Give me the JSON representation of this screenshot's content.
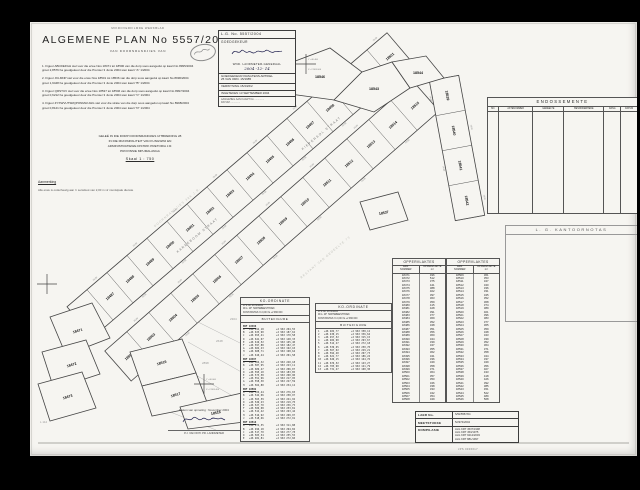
{
  "colors": {
    "page_bg": "#f6f5f1",
    "ink": "#2b2b2b",
    "line": "#555555",
    "faint": "#b5b5b5",
    "signature_ink": "#1a1a4a"
  },
  "header": {
    "microfilm": "MIKROVERFILMDE  WERKBLAD",
    "title": "ALGEMENE  PLAN  No  5557/2004",
    "subtitle": "VAN   DOORNRANDJIES   VAN",
    "notes": [
      "1.  Figuur ABCDEFGH stel voor die erwe Nos 18471 tot 18500 van die dorp soos aangedui op kaart No 8995/2004\n      groot 2,8576 ha        goedgekeur deur die Premier 3 Junie 2004        sien kaart \"A\" 1/2004",
      "2.  Figuur JKLMNP stel voor die erwe Nos 18501 tot 18536 van die dorp soos aangedui op kaart No 8996/2004\n      groot 1,9448 ha        goedgekeur deur die Premier 3 Junie 2004        sien kaart \"B\" 1/2004",
      "3.  Figuur QRSTUV stel voor die erwe Nos 18537 tot 18546 van die dorp soos aangedui op kaart No 8997/2004\n      groot 0,6212 ha        goedgekeur deur die Premier 3 Junie 2004        sien kaart \"C\" 1/2004",
      "4.  Figuur ZYXWVUTSRQPONMLKJHG stel voor die strate van die dorp soos aangedui op kaart No 8998/2004\n      groot 0,8121 ha        goedgekeur deur die Premier 3 Junie 2004        sien kaart \"D\" 1/2004"
    ],
    "located": [
      "GELEË IN DIE DORP DOORNRANDJIES UITBREIDING 28",
      "IN DIE MUNISIPALITEIT VAN KUNGWINI EN",
      "ADMINISTRATIEWE DISTRIK PRETORIA J.R.",
      "PROVINSIE MPUMALANGA"
    ],
    "scale": "Skaal   1 : 750",
    "remark_title": "Aanmerking",
    "remark": "Alle erwe is onderhewig aan 'n serwituut van 2,00 m vir munisipale dienste"
  },
  "approval": {
    "lg_no": "L.G. No.  5557/2004",
    "approved": "GOEDGEKEUR",
    "actor": "WND. LANDMETER-GENERAAL",
    "date_hand": "2004 -12- 14",
    "kragtens1": "GOEDGEKEUR KRAGTENS ARTIKEL",
    "kragtens2": "25 VAN ORD. 15/1985",
    "verwysing": "VERWYSING    15/4/26/2",
    "ingeteken": "INGETEKEN    13 SEPTEMBER 2004",
    "attach1": "AANGEHEG AAN KAART No ..............",
    "attach2": "DATUM .............."
  },
  "endorsements": {
    "title": "ENDOSSEMENTE",
    "columns": [
      "NO.",
      "AKTENOMMER",
      "GEDEELTE",
      "BESONDERHEDE",
      "RANG",
      "DATUM"
    ],
    "col_widths": [
      7,
      23,
      21,
      27,
      11,
      11
    ]
  },
  "office_notes": {
    "title": "L. G.   KANTOORNOTAS"
  },
  "areas": {
    "title": "OPPERVLAKTES",
    "col1": "ERF\nNOMMER",
    "col2": "OPPERVLAKTE\nm²",
    "left": [
      [
        "18471",
        "496"
      ],
      [
        "18472",
        "512"
      ],
      [
        "18473",
        "375"
      ],
      [
        "18474",
        "441"
      ],
      [
        "18475",
        "388"
      ],
      [
        "18476",
        "402"
      ],
      [
        "18477",
        "397"
      ],
      [
        "18478",
        "363"
      ],
      [
        "18479",
        "359"
      ],
      [
        "18480",
        "415"
      ],
      [
        "18481",
        "428"
      ],
      [
        "18482",
        "391"
      ],
      [
        "18483",
        "377"
      ],
      [
        "18484",
        "369"
      ],
      [
        "18485",
        "352"
      ],
      [
        "18486",
        "348"
      ],
      [
        "18487",
        "351"
      ],
      [
        "18488",
        "356"
      ],
      [
        "18489",
        "360"
      ],
      [
        "18490",
        "344"
      ],
      [
        "18491",
        "339"
      ],
      [
        "18492",
        "347"
      ],
      [
        "18493",
        "355"
      ],
      [
        "18494",
        "362"
      ],
      [
        "18495",
        "341"
      ],
      [
        "18496",
        "336"
      ],
      [
        "18497",
        "349"
      ],
      [
        "18498",
        "358"
      ],
      [
        "18499",
        "371"
      ],
      [
        "18500",
        "364"
      ],
      [
        "18501",
        "357"
      ],
      [
        "18502",
        "350"
      ],
      [
        "18503",
        "346"
      ],
      [
        "18504",
        "338"
      ],
      [
        "18505",
        "333"
      ],
      [
        "18506",
        "342"
      ],
      [
        "18507",
        "354"
      ],
      [
        "18508",
        "349"
      ]
    ],
    "right": [
      [
        "18509",
        "361"
      ],
      [
        "18510",
        "353"
      ],
      [
        "18511",
        "347"
      ],
      [
        "18512",
        "340"
      ],
      [
        "18513",
        "336"
      ],
      [
        "18514",
        "331"
      ],
      [
        "18515",
        "345"
      ],
      [
        "18516",
        "352"
      ],
      [
        "18517",
        "368"
      ],
      [
        "18518",
        "374"
      ],
      [
        "18519",
        "389"
      ],
      [
        "18520",
        "401"
      ],
      [
        "18521",
        "396"
      ],
      [
        "18522",
        "383"
      ],
      [
        "18523",
        "377"
      ],
      [
        "18524",
        "365"
      ],
      [
        "18525",
        "359"
      ],
      [
        "18526",
        "348"
      ],
      [
        "18527",
        "343"
      ],
      [
        "18528",
        "339"
      ],
      [
        "18529",
        "352"
      ],
      [
        "18530",
        "364"
      ],
      [
        "18531",
        "371"
      ],
      [
        "18532",
        "358"
      ],
      [
        "18533",
        "344"
      ],
      [
        "18534",
        "337"
      ],
      [
        "18535",
        "349"
      ],
      [
        "18536",
        "356"
      ],
      [
        "18537",
        "407"
      ],
      [
        "18538",
        "433"
      ],
      [
        "18539",
        "418"
      ],
      [
        "18540",
        "426"
      ],
      [
        "18541",
        "392"
      ],
      [
        "18542",
        "385"
      ],
      [
        "18543",
        "451"
      ],
      [
        "18544",
        "522"
      ],
      [
        "18545",
        "489"
      ],
      [
        "18546",
        "568"
      ]
    ]
  },
  "coords": {
    "title": "KO-ORDINATE",
    "info": [
      "LYS No.  2974/2004",
      "W.G. 29°   HARTEBEESTHOEK",
      "KONSTANTES   Yo  0,00    Xo  +2 960 000"
    ],
    "section": "BUITEFIGURE",
    "t1_groups": [
      {
        "h": "ERF 18486",
        "rows": [
          [
            "A",
            "+46 612,18",
            "+2 963 204,55"
          ],
          [
            "B",
            "+46 633,90",
            "+2 963 187,62"
          ],
          [
            "C",
            "+46 655,41",
            "+2 963 170,58"
          ],
          [
            "D",
            "+46 641,07",
            "+2 963 148,33"
          ],
          [
            "E",
            "+46 619,52",
            "+2 963 165,40"
          ],
          [
            "F",
            "+46 597,88",
            "+2 963 182,47"
          ],
          [
            "G",
            "+46 604,23",
            "+2 963 192,10"
          ],
          [
            "H",
            "+46 608,71",
            "+2 963 198,64"
          ],
          [
            "J",
            "+46 610,44",
            "+2 963 201,58"
          ]
        ]
      },
      {
        "h": "ERF 18487",
        "rows": [
          [
            "A",
            "+46 566,32",
            "+2 963 240,18"
          ],
          [
            "B",
            "+46 587,95",
            "+2 963 223,11"
          ],
          [
            "C",
            "+46 609,47",
            "+2 963 206,07"
          ],
          [
            "D",
            "+46 595,10",
            "+2 963 183,85"
          ],
          [
            "E",
            "+46 573,58",
            "+2 963 200,90"
          ],
          [
            "F",
            "+46 551,96",
            "+2 963 217,95"
          ],
          [
            "G",
            "+46 558,30",
            "+2 963 227,59"
          ],
          [
            "H",
            "+46 562,80",
            "+2 963 234,12"
          ]
        ]
      },
      {
        "h": "ERF 18502",
        "rows": [
          [
            "A",
            "+46 520,44",
            "+2 963 276,03"
          ],
          [
            "B",
            "+46 542,06",
            "+2 963 258,97"
          ],
          [
            "C",
            "+46 563,59",
            "+2 963 241,92"
          ],
          [
            "D",
            "+46 549,23",
            "+2 963 219,70"
          ],
          [
            "E",
            "+46 527,70",
            "+2 963 236,75"
          ],
          [
            "F",
            "+46 506,08",
            "+2 963 253,81"
          ],
          [
            "G",
            "+46 512,42",
            "+2 963 263,44"
          ],
          [
            "H",
            "+46 516,92",
            "+2 963 269,97"
          ],
          [
            "J",
            "+46 518,66",
            "+2 963 272,91"
          ]
        ]
      },
      {
        "h": "ERF 18516",
        "rows": [
          [
            "A",
            "+46 474,55",
            "+2 963 311,88"
          ],
          [
            "B",
            "+46 496,18",
            "+2 963 294,82"
          ],
          [
            "C",
            "+46 517,70",
            "+2 963 277,78"
          ],
          [
            "D",
            "+46 503,34",
            "+2 963 255,55"
          ],
          [
            "E",
            "+46 481,81",
            "+2 963 272,60"
          ]
        ]
      }
    ],
    "t2_rows": [
      [
        "1",
        "+46 402,77",
        "+2 963 358,12"
      ],
      [
        "2",
        "+46 430,15",
        "+2 963 336,64"
      ],
      [
        "3",
        "+46 457,52",
        "+2 963 315,15"
      ],
      [
        "4",
        "+46 484,90",
        "+2 963 293,67"
      ],
      [
        "5",
        "+46 512,27",
        "+2 963 272,18"
      ],
      [
        "6",
        "+46 539,65",
        "+2 963 250,70"
      ],
      [
        "7",
        "+46 567,02",
        "+2 963 229,21"
      ],
      [
        "8",
        "+46 594,40",
        "+2 963 207,73"
      ],
      [
        "9",
        "+46 621,77",
        "+2 963 186,24"
      ],
      [
        "10",
        "+46 649,15",
        "+2 963 164,76"
      ],
      [
        "11",
        "+46 676,52",
        "+2 963 143,27"
      ],
      [
        "12",
        "+46 703,90",
        "+2 963 121,79"
      ],
      [
        "13",
        "+46 731,27",
        "+2 963 100,30"
      ]
    ]
  },
  "signature_block": {
    "line1": "Datum van opmeting :  November 2004",
    "caption": "P.J. VAN WYK       PR. LANDMETER"
  },
  "filing": {
    "rows": [
      [
        "LAER No.",
        "S/W/5557/04"
      ],
      [
        "MEETSTUKKE",
        "5/2974/2004"
      ],
      [
        "KOMPILASIE",
        "ALG KRT 4537/1998|ALG KRT 453/1975|ALG KRT 9212/2003|ALG KRT 881/1997"
      ]
    ],
    "foot": "JPS  0306617"
  },
  "corner_note": "L 112",
  "drawing": {
    "bands": [
      {
        "x1": 50,
        "y1": 300,
        "x2": 370,
        "y2": 26,
        "w": 40,
        "dim": "20,00",
        "lots": [
          "18486",
          "18487",
          "18488",
          "18489",
          "18490",
          "18491",
          "18492",
          "18493",
          "18494",
          "18495",
          "18496",
          "18497",
          "18498",
          "18499",
          "18500",
          "18501"
        ]
      },
      {
        "x1": 88,
        "y1": 344,
        "x2": 396,
        "y2": 74,
        "w": 40,
        "dim": "20,00",
        "lots": [
          "18502",
          "18503",
          "18504",
          "18505",
          "18506",
          "18507",
          "18508",
          "18509",
          "18510",
          "18511",
          "18512",
          "18513",
          "18514",
          "18515"
        ]
      },
      {
        "x1": 414,
        "y1": 56,
        "x2": 440,
        "y2": 196,
        "w": 30,
        "dim": "18,00",
        "lots": [
          "18539",
          "18540",
          "18541",
          "18542"
        ]
      }
    ],
    "polys": [
      {
        "pts": "252,44 300,26 332,50 304,78 260,72",
        "label": "18546",
        "lx": 290,
        "ly": 56,
        "r": 0
      },
      {
        "pts": "332,50 362,40 380,66 344,90 304,78",
        "label": "18543",
        "lx": 344,
        "ly": 68,
        "r": 0
      },
      {
        "pts": "362,40 396,34 414,56 380,66",
        "label": "18544",
        "lx": 388,
        "ly": 52,
        "r": 0
      },
      {
        "pts": "330,180 368,170 378,198 340,208",
        "label": "18537",
        "lx": 354,
        "ly": 192,
        "r": -12
      },
      {
        "pts": "20,295 62,281 80,316 36,333",
        "label": "18471",
        "lx": 48,
        "ly": 310,
        "r": -18
      },
      {
        "pts": "12,330 56,318 70,352 24,367",
        "label": "18472",
        "lx": 42,
        "ly": 344,
        "r": -18
      },
      {
        "pts": "8,362 52,350 66,386 20,399",
        "label": "18473",
        "lx": 38,
        "ly": 376,
        "r": -18
      },
      {
        "pts": "100,330 152,317 166,351 112,364",
        "label": "18516",
        "lx": 132,
        "ly": 342,
        "r": -18
      },
      {
        "pts": "112,364 166,351 178,383 122,394",
        "label": "18517",
        "lx": 146,
        "ly": 374,
        "r": -18
      },
      {
        "pts": "150,385 212,371 222,399 158,407",
        "label": "18518",
        "lx": 186,
        "ly": 392,
        "r": -12
      }
    ],
    "open_lines": [
      [
        168,
        300,
        232,
        332
      ],
      [
        158,
        320,
        222,
        356
      ],
      [
        146,
        342,
        210,
        378
      ],
      [
        132,
        362,
        198,
        396
      ],
      [
        120,
        382,
        186,
        408
      ],
      [
        222,
        399,
        280,
        416
      ]
    ],
    "open_labels": [
      [
        "2304",
        200,
        298
      ],
      [
        "2648",
        186,
        320
      ],
      [
        "2898",
        172,
        342
      ],
      [
        "2748",
        156,
        364
      ],
      [
        "2394",
        142,
        388
      ]
    ],
    "street_labels": [
      {
        "t": "KAREEBOOM   STRAAT",
        "x": 168,
        "y": 214,
        "r": -40
      },
      {
        "t": "KIEPERSOL   STRAAT",
        "x": 292,
        "y": 112,
        "r": -40
      }
    ],
    "farm_labels": [
      {
        "t": "DOORNRANDJIES   386   J.R.",
        "x": 148,
        "y": 186,
        "r": -40
      },
      {
        "t": "RESTANT   VAN   GEDEELTE   73",
        "x": 296,
        "y": 236,
        "r": -40
      }
    ],
    "crosses": [
      {
        "x": 276,
        "y": 42,
        "t1": "Y +46 400",
        "t2": "X +2 963 000"
      },
      {
        "x": 17,
        "y": 262,
        "t1": "",
        "t2": ""
      },
      {
        "x": 174,
        "y": 362,
        "t1": "Y +46 600",
        "t2": "X +2 963 400"
      }
    ]
  }
}
